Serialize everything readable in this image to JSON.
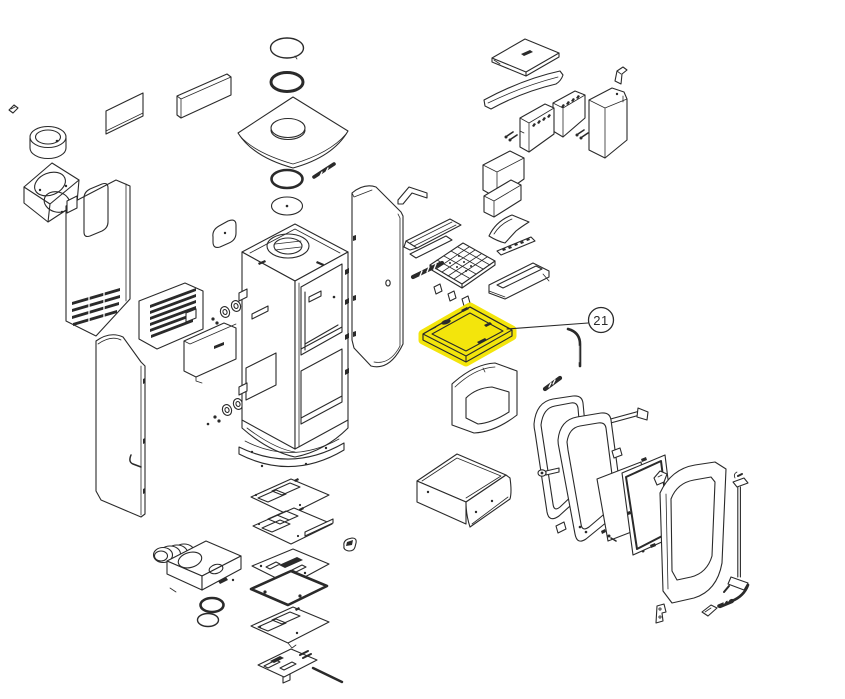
{
  "diagram": {
    "type": "exploded-parts-diagram",
    "subject": "stove-parts-exploded-view",
    "background_color": "#ffffff",
    "line_color": "#2a2a2a",
    "highlight_color": "#f3e400",
    "callout": {
      "label": "21"
    },
    "highlighted_part": "baffle-plate-part-21",
    "parts": [
      "flue-collar-ring",
      "smoke-outlet-box",
      "rear-shield-panel-small",
      "rear-shield-panel-large",
      "top-ring",
      "top-gasket-ring",
      "top-plate-with-hole",
      "damper-pin",
      "collar-gasket",
      "collar-blank-disc",
      "top-lid-plate",
      "curved-baffle-plank",
      "small-bracket",
      "firebrick-left",
      "firebrick-mid",
      "firebrick-back",
      "side-brick-right",
      "left-rear-panel",
      "oval-cover-plate",
      "louver-panel",
      "hinge-set-upper",
      "hinge-set-lower",
      "left-side-panel",
      "lower-heat-shield",
      "main-body",
      "right-side-panel",
      "grate-bracket",
      "inner-back-panel",
      "grate-rail",
      "grate-curved-guide",
      "toothed-rail",
      "fire-grate",
      "hatched-bar",
      "front-rail",
      "baffle-plate-part-21",
      "front-top-panel",
      "wire-handle",
      "hatched-pin",
      "ash-box",
      "door-gasket-frame",
      "door-frame",
      "door-handle",
      "glass-panel",
      "glass-gasket-panel",
      "glass-clip",
      "outer-door",
      "hinge-rod",
      "latch-lever",
      "door-bracket-left",
      "door-bracket-right",
      "base-curved-plate",
      "base-plate-a",
      "base-plate-b",
      "base-plate-c",
      "base-seal-plate",
      "duct-box",
      "duct-hose",
      "gasket-ring-1",
      "gasket-ring-2",
      "base-plate-d",
      "grate-slider-with-rod",
      "small-clip"
    ]
  }
}
